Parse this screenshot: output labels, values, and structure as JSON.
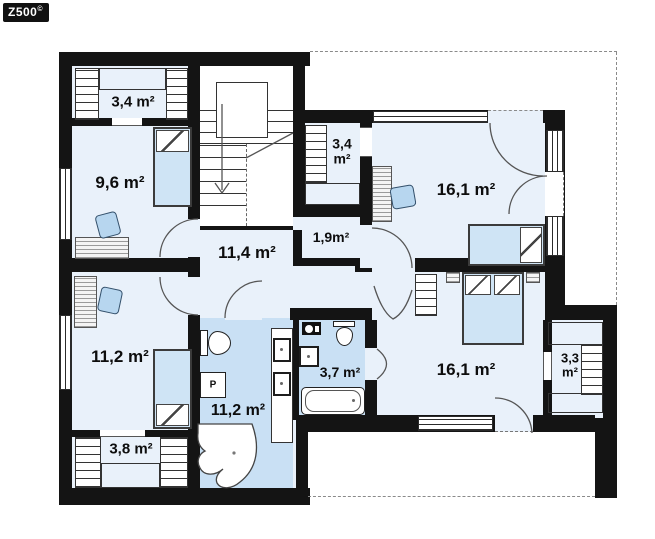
{
  "logo": {
    "brand": "Z500",
    "mark": "©"
  },
  "plan_title": "upper floor plan",
  "rooms": {
    "wardrobe_top_left": {
      "label": "3,4 m²"
    },
    "bedroom_top_left": {
      "label": "9,6 m²"
    },
    "wardrobe_by_stairs": {
      "line1": "3,4",
      "line2": "m²"
    },
    "bedroom_top_right": {
      "label": "16,1 m²"
    },
    "hall": {
      "label": "11,4 m²"
    },
    "storage": {
      "label": "1,9m²"
    },
    "bedroom_bottom_left": {
      "label": "11,2 m²"
    },
    "bathroom_main": {
      "label": "11,2 m²"
    },
    "bathroom_ensuite": {
      "label": "3,7 m²"
    },
    "bedroom_bottom_right": {
      "label": "16,1 m²"
    },
    "wardrobe_right": {
      "line1": "3,3",
      "line2": "m²"
    },
    "wardrobe_bottom_left": {
      "label": "3,8 m²"
    }
  },
  "appliances": {
    "washer_label": "P"
  },
  "colors": {
    "wall": "#141414",
    "floor": "#e9f1fa",
    "bath": "#c9e0f4",
    "furniture": "#cfe4f5",
    "stairdash": "#dfecf8",
    "line": "#555555"
  }
}
